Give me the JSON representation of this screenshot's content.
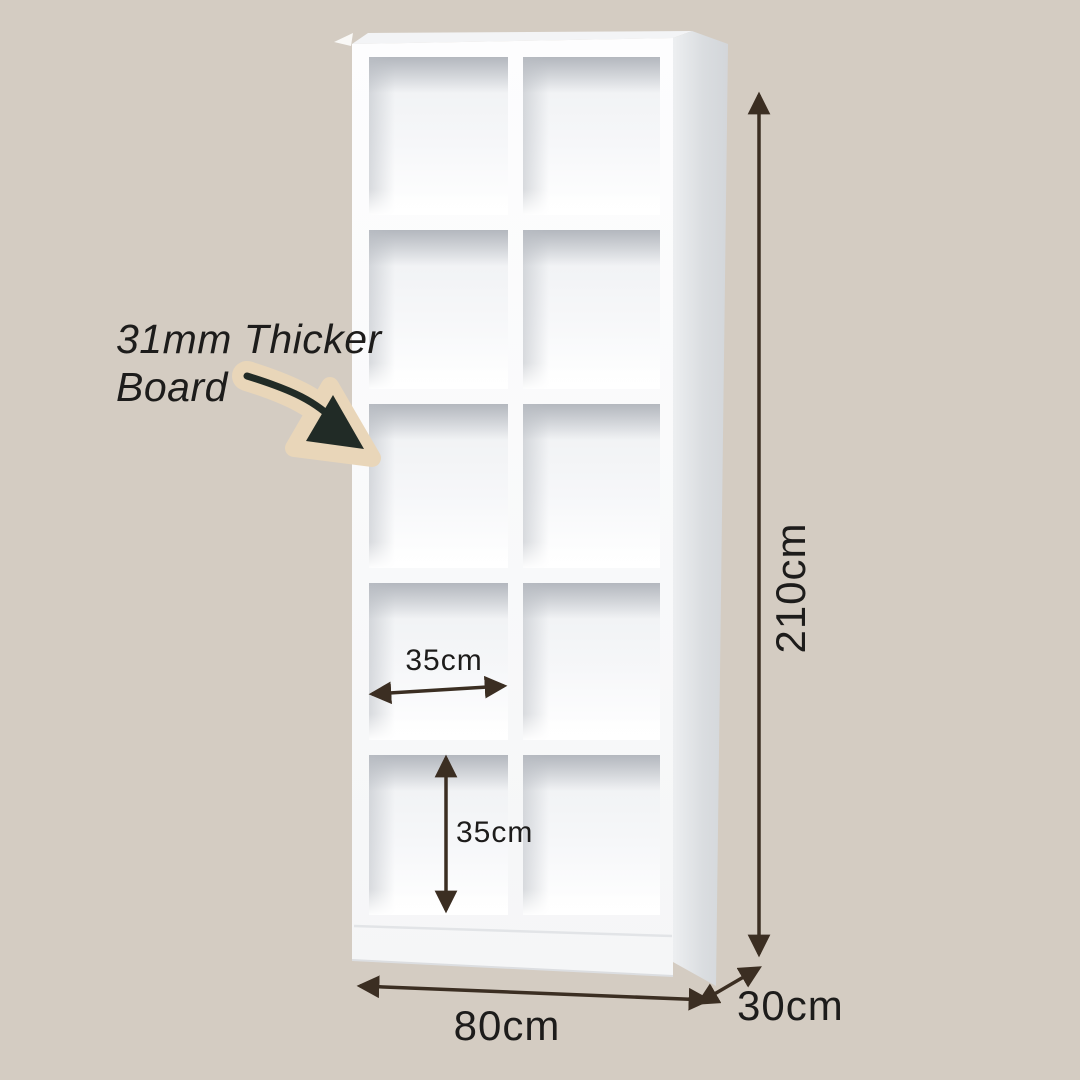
{
  "title": "Bookshelf dimension diagram",
  "colors": {
    "background": "#d4ccc2",
    "text": "#1d1c1b",
    "dimension_line": "#3b2e22",
    "note_arrow": "#212b26",
    "note_arrow_glow": "#e9d6b9",
    "shelf_white": "#fbfcfd",
    "shelf_side_shade": "#d3d6da",
    "cube_shadow": "#b0b4bb"
  },
  "shelf": {
    "rows": 5,
    "columns": 2,
    "cells": 10
  },
  "annotations": {
    "note_line1": "31mm Thicker",
    "note_line2": "Board",
    "height": "210cm",
    "width": "80cm",
    "depth": "30cm",
    "cell_width": "35cm",
    "cell_height": "35cm"
  },
  "icons": {
    "note_arrow": "curved-arrow-icon",
    "height_dim": "double-arrow-vertical-icon",
    "width_dim": "double-arrow-horizontal-icon",
    "depth_dim": "double-arrow-diagonal-icon"
  }
}
